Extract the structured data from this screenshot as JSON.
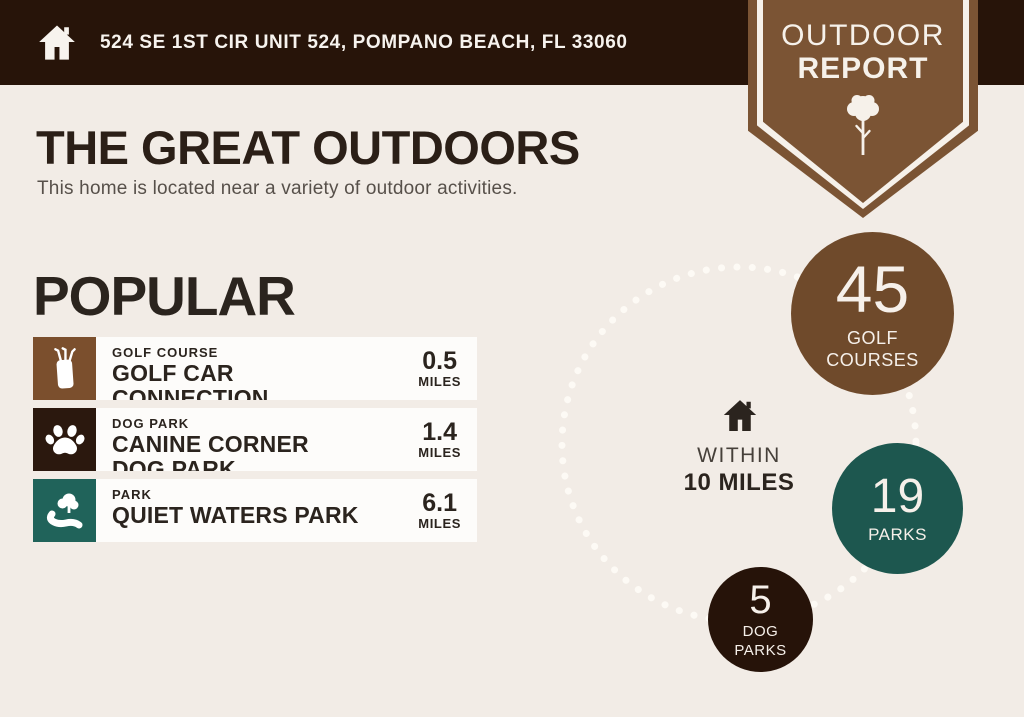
{
  "header": {
    "address": "524 SE 1ST CIR UNIT 524, POMPANO BEACH, FL 33060",
    "icon": "home-icon",
    "background_color": "#271409"
  },
  "ribbon": {
    "line1": "OUTDOOR",
    "line2": "REPORT",
    "icon": "tree-icon",
    "color": "#7b5434"
  },
  "intro": {
    "title": "THE GREAT OUTDOORS",
    "subtitle": "This home is located near a variety of outdoor activities."
  },
  "popular": {
    "heading": "POPULAR",
    "items": [
      {
        "category": "GOLF COURSE",
        "name": "GOLF CAR CONNECTION",
        "distance": "0.5",
        "unit": "MILES",
        "icon": "golf-bag-icon",
        "tile_color": "#7b4f2d"
      },
      {
        "category": "DOG PARK",
        "name": "CANINE CORNER DOG PARK",
        "distance": "1.4",
        "unit": "MILES",
        "icon": "paw-icon",
        "tile_color": "#2b180e"
      },
      {
        "category": "PARK",
        "name": "QUIET WATERS PARK",
        "distance": "6.1",
        "unit": "MILES",
        "icon": "park-icon",
        "tile_color": "#20635a"
      }
    ]
  },
  "radius_viz": {
    "icon": "home-icon",
    "label_line1": "WITHIN",
    "label_line2": "10 MILES",
    "dotted_circle_color": "#fdfaf5",
    "stats": [
      {
        "value": "45",
        "label": "GOLF COURSES",
        "color": "#6f4a2b"
      },
      {
        "value": "19",
        "label": "PARKS",
        "color": "#1d574f"
      },
      {
        "value": "5",
        "label": "DOG PARKS",
        "color": "#261309"
      }
    ]
  },
  "colors": {
    "background": "#f2ece6",
    "text_dark": "#2b241e",
    "text_gray": "#57504a",
    "row_background": "#fdfcfa"
  }
}
